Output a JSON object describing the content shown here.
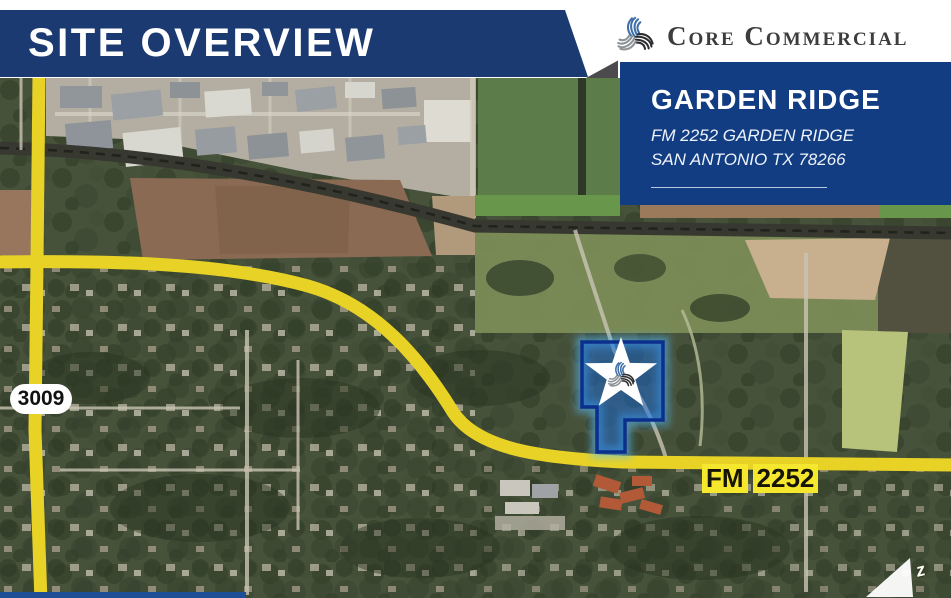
{
  "page": {
    "title": "SITE OVERVIEW"
  },
  "brand": {
    "name": "Core Commercial",
    "icon": "core-commercial-swirl-icon"
  },
  "property": {
    "name": "GARDEN RIDGE",
    "address_line1": "FM 2252 GARDEN RIDGE",
    "address_line2": "SAN ANTONIO TX 78266"
  },
  "map": {
    "type": "satellite-aerial",
    "shield_3009": "3009",
    "highway_label": {
      "part1": "FM",
      "part2": "2252"
    },
    "north_indicator": "z",
    "site_marker": "white star with Core Commercial swirl on blue highlighted parcel"
  },
  "colors": {
    "banner_blue": "#1b3a71",
    "card_blue": "#123d82",
    "road_yellow": "#e8d226",
    "label_yellow": "#f5e62e",
    "parcel_fill": "#1563d6",
    "parcel_outline": "#0a2f8c"
  }
}
